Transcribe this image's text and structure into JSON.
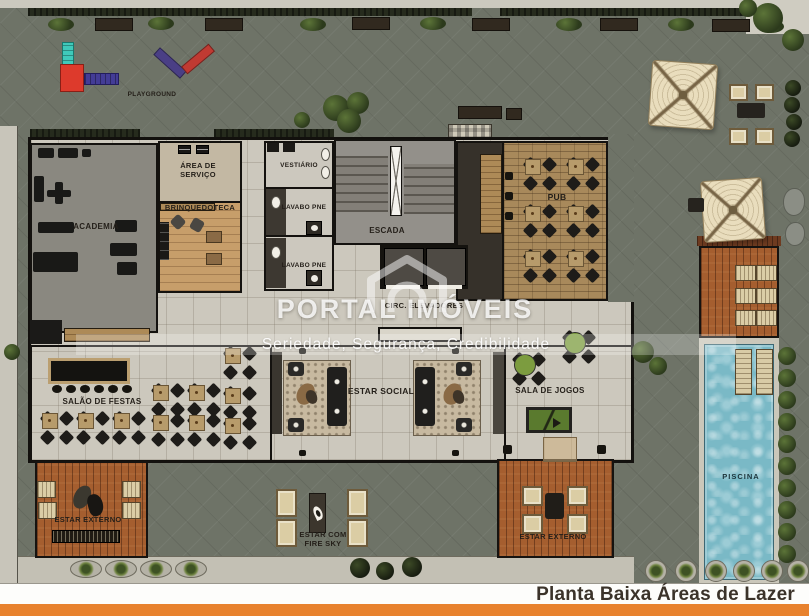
{
  "image": {
    "width": 809,
    "height": 616,
    "kind": "architectural floor plan"
  },
  "watermark": {
    "brand": "PORTAL IMÓVEIS",
    "tagline": "Seriedade, Segurança, Credibilidade",
    "logo": "house-icon"
  },
  "caption": {
    "text": "Planta Baixa Áreas de Lazer"
  },
  "rooms": {
    "playground": {
      "label": "PLAYGROUND"
    },
    "academia": {
      "label": "ACADEMIA"
    },
    "area_de_servico": {
      "label": "ÁREA DE SERVIÇO"
    },
    "brinquedoteca": {
      "label": "BRINQUEDOTECA"
    },
    "vestiario": {
      "label": "VESTIÁRIO"
    },
    "lavabo_pne_1": {
      "label": "LAVABO PNE"
    },
    "lavabo_pne_2": {
      "label": "LAVABO PNE"
    },
    "escada": {
      "label": "ESCADA"
    },
    "circ_elevadores": {
      "label": "CIRC. ELEVADORES"
    },
    "pub": {
      "label": "PUB"
    },
    "salao_de_festas": {
      "label": "SALÃO DE FESTAS"
    },
    "estar_social": {
      "label": "ESTAR SOCIAL"
    },
    "sala_de_jogos": {
      "label": "SALA DE JOGOS"
    },
    "estar_externo_1": {
      "label": "ESTAR EXTERNO"
    },
    "estar_com_fire_sky": {
      "label": "ESTAR COM FIRE SKY"
    },
    "estar_externo_2": {
      "label": "ESTAR EXTERNO"
    },
    "piscina": {
      "label": "PISCINA"
    }
  },
  "colors": {
    "paving": "#6e7367",
    "interior_floor": "#ccc8bd",
    "wood_deck": "#a55e2f",
    "pool_water": "#7ab9c6",
    "accent_bar": "#e8822e",
    "wall": "#12100d"
  }
}
